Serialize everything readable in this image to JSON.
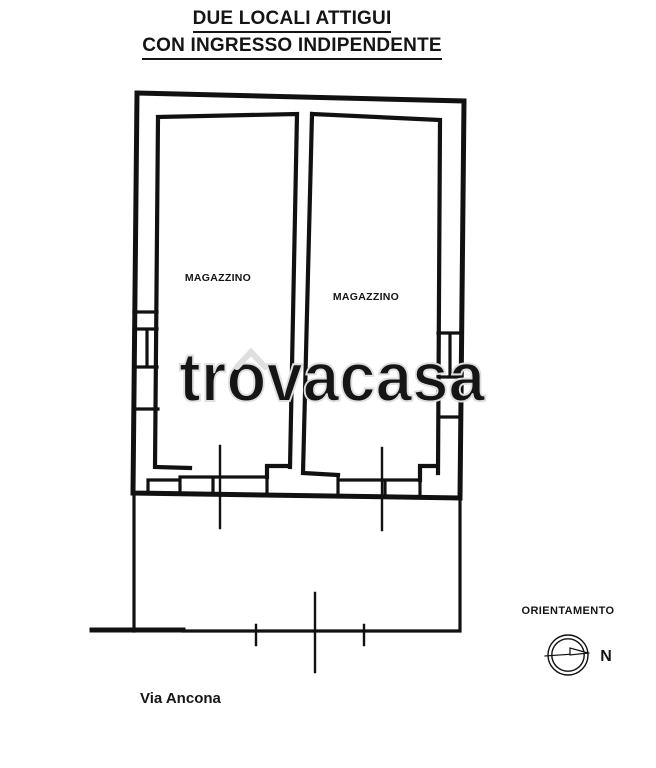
{
  "title": {
    "line1": "DUE LOCALI ATTIGUI",
    "line2": "CON INGRESSO INDIPENDENTE"
  },
  "rooms": {
    "left_label": "MAGAZZINO",
    "right_label": "MAGAZZINO"
  },
  "street": {
    "label": "Via Ancona"
  },
  "compass": {
    "label": "ORIENTAMENTO",
    "north_label": "N"
  },
  "watermark": {
    "text": "trovacasa",
    "color": "#dfdfdf"
  },
  "colors": {
    "ink": "#151515",
    "background": "#ffffff"
  }
}
